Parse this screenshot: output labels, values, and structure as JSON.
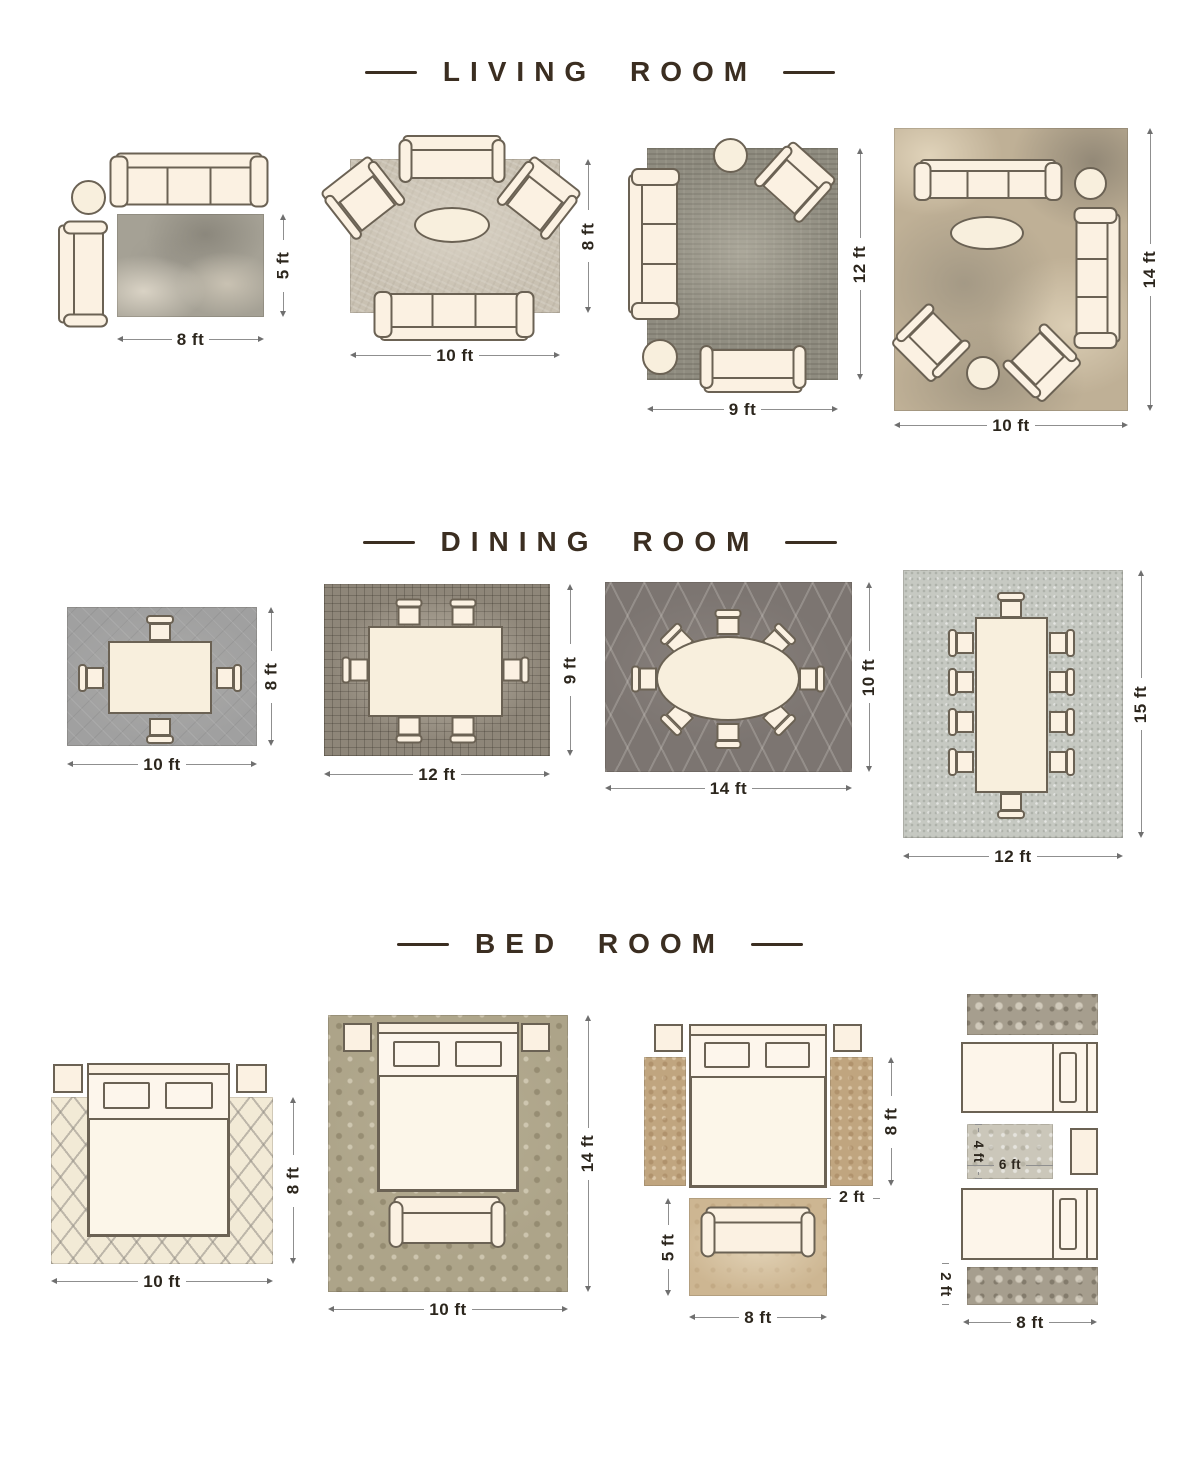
{
  "sections": [
    {
      "title": "LIVING ROOM",
      "layouts": [
        {
          "w": "8 ft",
          "h": "5 ft"
        },
        {
          "w": "10 ft",
          "h": "8 ft"
        },
        {
          "w": "9 ft",
          "h": "12 ft"
        },
        {
          "w": "10 ft",
          "h": "14 ft"
        }
      ]
    },
    {
      "title": "DINING ROOM",
      "layouts": [
        {
          "w": "10 ft",
          "h": "8 ft"
        },
        {
          "w": "12 ft",
          "h": "9 ft"
        },
        {
          "w": "14 ft",
          "h": "10 ft"
        },
        {
          "w": "12 ft",
          "h": "15 ft"
        }
      ]
    },
    {
      "title": "BED ROOM",
      "layouts": [
        {
          "w": "10 ft",
          "h": "8 ft"
        },
        {
          "w": "10 ft",
          "h": "14 ft"
        },
        {
          "rug_w": "8 ft",
          "rug_h": "5 ft",
          "runner_len": "8 ft",
          "runner_w": "2 ft"
        },
        {
          "w": "8 ft",
          "mat_w": "6 ft",
          "mat_h": "4 ft",
          "runner_w": "2 ft"
        }
      ]
    }
  ],
  "colors": {
    "background": "#ffffff",
    "title_text": "#3b2e21",
    "dim_text": "#2c261d",
    "dim_line": "#8f8f8f",
    "furniture_fill": "#fbf1e2",
    "furniture_outline": "#6b6254",
    "rug_gray": "#a5a195",
    "rug_dark_gray": "#7c7571",
    "rug_cream": "#f2ead6",
    "rug_tan": "#c0a57f",
    "rug_sage": "#ada489"
  }
}
